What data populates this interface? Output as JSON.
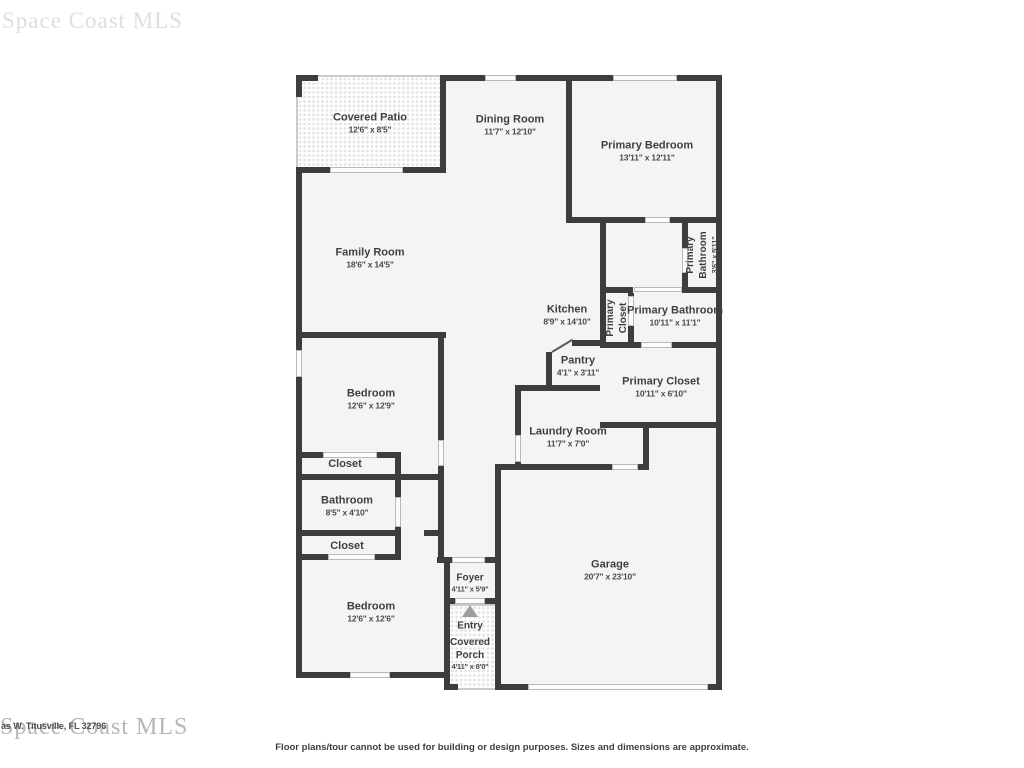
{
  "watermark": {
    "text": "Space Coast MLS",
    "address_fragment": "as W. Titusville, FL 32796"
  },
  "footer": {
    "disclaimer": "Floor plans/tour cannot be used for building or design purposes. Sizes and dimensions are approximate."
  },
  "colors": {
    "wall": "#3d3d3d",
    "room_fill": "#f4f4f4",
    "outdoor_border": "#cacaca",
    "label_text": "#3f3f3f",
    "watermark_gray": "#b6b6b6",
    "entry_arrow": "#9e9e9e"
  },
  "icons": {
    "entry_arrow": "triangle-up"
  },
  "rooms": [
    {
      "name": "Covered Patio",
      "dims": "12'6\" x 8'5\""
    },
    {
      "name": "Dining Room",
      "dims": "11'7\" x 12'10\""
    },
    {
      "name": "Primary Bedroom",
      "dims": "13'11\" x 12'11\""
    },
    {
      "name": "Family Room",
      "dims": "18'6\" x 14'5\""
    },
    {
      "name": "Primary Bathroom",
      "dims": "3'6\" x 5'11\""
    },
    {
      "name": "Kitchen",
      "dims": "8'9\" x 14'10\""
    },
    {
      "name": "Primary Closet",
      "dims": ""
    },
    {
      "name": "Primary Bathroom",
      "dims": "10'11\" x 11'1\""
    },
    {
      "name": "Pantry",
      "dims": "4'1\" x 3'11\""
    },
    {
      "name": "Primary Closet",
      "dims": "10'11\" x 6'10\""
    },
    {
      "name": "Laundry Room",
      "dims": "11'7\" x 7'0\""
    },
    {
      "name": "Bedroom",
      "dims": "12'6\" x 12'9\""
    },
    {
      "name": "Closet",
      "dims": ""
    },
    {
      "name": "Bathroom",
      "dims": "8'5\" x 4'10\""
    },
    {
      "name": "Closet",
      "dims": ""
    },
    {
      "name": "Bedroom",
      "dims": "12'6\" x 12'6\""
    },
    {
      "name": "Foyer",
      "dims": "4'11\" x 5'9\""
    },
    {
      "name": "Entry",
      "dims": ""
    },
    {
      "name": "Covered Porch",
      "dims": "4'11\" x 8'0\""
    },
    {
      "name": "Garage",
      "dims": "20'7\" x 23'10\""
    }
  ]
}
